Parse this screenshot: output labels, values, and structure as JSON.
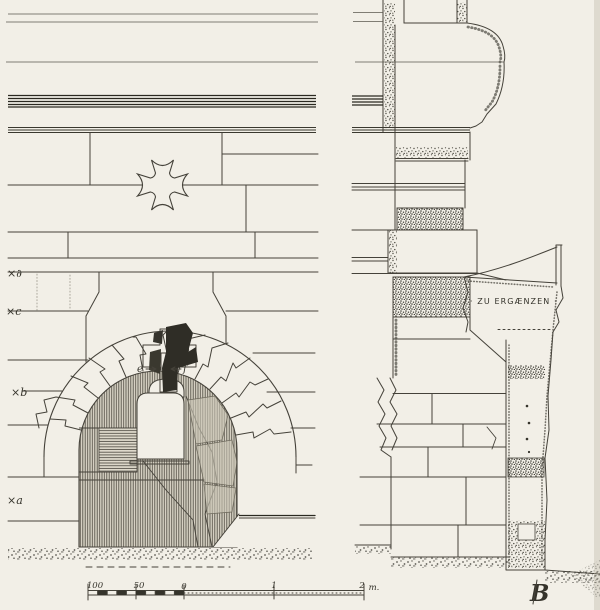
{
  "drawing": {
    "type": "architectural elevation and wall section, ink survey drawing",
    "markers": {
      "d": "×∂",
      "c": "×c",
      "b": "×b",
      "a": "×a"
    },
    "stone_labels": {
      "e": "e",
      "f": "f"
    },
    "note": "· ZU ERGÆNZEN ·",
    "monogram": "B",
    "scale_bar": {
      "labels": [
        "100",
        "50",
        "0",
        "1",
        "2"
      ],
      "unit": "m."
    },
    "colors": {
      "paper": "#f2efe7",
      "ink": "#45423a",
      "dark_ink": "#2b2921",
      "solid_fill": "#2f2d26",
      "stone_wash": "#ccc7b6"
    }
  }
}
